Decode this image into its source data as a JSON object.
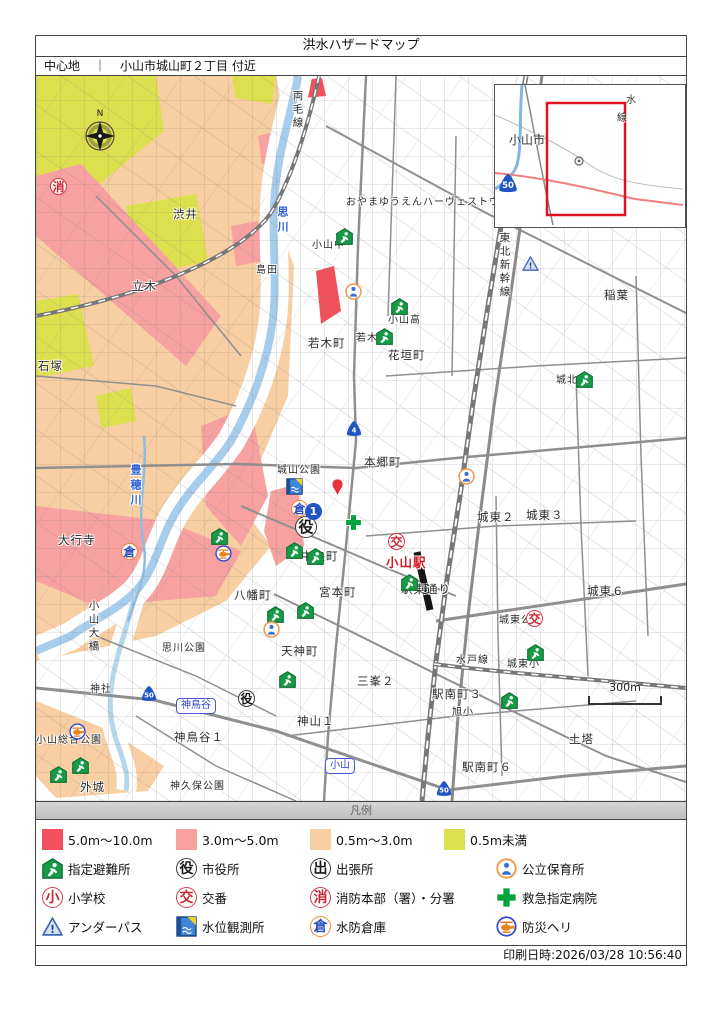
{
  "page": {
    "title": "洪水ハザードマップ",
    "center_label": "中心地",
    "separator": "｜",
    "center_value": "小山市城山町２丁目 付近",
    "print_datetime": "印刷日時:2026/03/28 10:56:40"
  },
  "inset": {
    "city": "小山市",
    "route": "50",
    "rail_char_top": "水",
    "rail_char_bottom": "線"
  },
  "map": {
    "compass": "N",
    "scale": "300m",
    "labels": [
      {
        "t": "渋井",
        "x": 137,
        "y": 133
      },
      {
        "t": "立木",
        "x": 96,
        "y": 205
      },
      {
        "t": "石塚",
        "x": 2,
        "y": 285
      },
      {
        "t": "両毛線",
        "x": 256,
        "y": 14,
        "c": "vert"
      },
      {
        "t": "思川",
        "x": 241,
        "y": 130,
        "c": "vblue"
      },
      {
        "t": "おやまゆうえんハーヴェストウォーク",
        "x": 310,
        "y": 122,
        "c": "small"
      },
      {
        "t": "小山中",
        "x": 276,
        "y": 165,
        "c": "small"
      },
      {
        "t": "島田",
        "x": 220,
        "y": 190,
        "c": "small"
      },
      {
        "t": "若木町",
        "x": 272,
        "y": 262
      },
      {
        "t": "小山高",
        "x": 352,
        "y": 240,
        "c": "small"
      },
      {
        "t": "若木小",
        "x": 320,
        "y": 258,
        "c": "small"
      },
      {
        "t": "花垣町",
        "x": 352,
        "y": 274
      },
      {
        "t": "稲葉",
        "x": 568,
        "y": 214
      },
      {
        "t": "東北新幹線",
        "x": 463,
        "y": 156,
        "c": "vert"
      },
      {
        "t": "城北小",
        "x": 520,
        "y": 300,
        "c": "small"
      },
      {
        "t": "本郷町",
        "x": 328,
        "y": 381
      },
      {
        "t": "城山公園",
        "x": 241,
        "y": 390,
        "c": "small"
      },
      {
        "t": "中央町",
        "x": 265,
        "y": 475
      },
      {
        "t": "小山駅",
        "x": 350,
        "y": 481,
        "c": "red"
      },
      {
        "t": "駅東通り",
        "x": 365,
        "y": 508
      },
      {
        "t": "宮本町",
        "x": 283,
        "y": 511
      },
      {
        "t": "八幡町",
        "x": 198,
        "y": 514
      },
      {
        "t": "大行寺",
        "x": 22,
        "y": 459
      },
      {
        "t": "豊穂川",
        "x": 94,
        "y": 388,
        "c": "vblue"
      },
      {
        "t": "思川公園",
        "x": 126,
        "y": 568,
        "c": "small"
      },
      {
        "t": "小山大橋",
        "x": 52,
        "y": 524,
        "c": "vert"
      },
      {
        "t": "天神町",
        "x": 245,
        "y": 570
      },
      {
        "t": "三峯２",
        "x": 321,
        "y": 600
      },
      {
        "t": "神山１",
        "x": 261,
        "y": 640
      },
      {
        "t": "城東２",
        "x": 441,
        "y": 436
      },
      {
        "t": "城東３",
        "x": 490,
        "y": 434
      },
      {
        "t": "城東６",
        "x": 551,
        "y": 510
      },
      {
        "t": "城東公園",
        "x": 463,
        "y": 540,
        "c": "small"
      },
      {
        "t": "城東小",
        "x": 471,
        "y": 584,
        "c": "small"
      },
      {
        "t": "水戸線",
        "x": 420,
        "y": 580,
        "c": "small"
      },
      {
        "t": "駅南町３",
        "x": 396,
        "y": 613
      },
      {
        "t": "旭小",
        "x": 416,
        "y": 632,
        "c": "small"
      },
      {
        "t": "駅南町６",
        "x": 426,
        "y": 686
      },
      {
        "t": "土塔",
        "x": 533,
        "y": 658
      },
      {
        "t": "外城",
        "x": 44,
        "y": 706
      },
      {
        "t": "神久保公園",
        "x": 134,
        "y": 706,
        "c": "small"
      },
      {
        "t": "神鳥谷１",
        "x": 138,
        "y": 656
      },
      {
        "t": "小山総合公園",
        "x": 0,
        "y": 660,
        "c": "small"
      },
      {
        "t": "神社",
        "x": 54,
        "y": 609,
        "c": "small"
      }
    ],
    "icons": [
      {
        "type": "shelter",
        "x": 300,
        "y": 152
      },
      {
        "type": "shelter",
        "x": 355,
        "y": 222
      },
      {
        "type": "shelter",
        "x": 340,
        "y": 252
      },
      {
        "type": "shelter",
        "x": 540,
        "y": 295
      },
      {
        "type": "shelter",
        "x": 175,
        "y": 452
      },
      {
        "type": "shelter",
        "x": 250,
        "y": 466
      },
      {
        "type": "shelter",
        "x": 271,
        "y": 472
      },
      {
        "type": "shelter",
        "x": 261,
        "y": 526
      },
      {
        "type": "shelter",
        "x": 231,
        "y": 530
      },
      {
        "type": "shelter",
        "x": 243,
        "y": 595
      },
      {
        "type": "shelter",
        "x": 365,
        "y": 498
      },
      {
        "type": "shelter",
        "x": 491,
        "y": 568
      },
      {
        "type": "shelter",
        "x": 465,
        "y": 616
      },
      {
        "type": "shelter",
        "x": 14,
        "y": 690
      },
      {
        "type": "shelter",
        "x": 36,
        "y": 681
      },
      {
        "type": "yakusho",
        "x": 259,
        "y": 440,
        "s": 22
      },
      {
        "type": "yakusho",
        "x": 202,
        "y": 614,
        "s": 17
      },
      {
        "type": "koban",
        "x": 352,
        "y": 457
      },
      {
        "type": "koban",
        "x": 490,
        "y": 534
      },
      {
        "type": "shobo",
        "x": 14,
        "y": 102
      },
      {
        "type": "hoiku",
        "x": 309,
        "y": 207
      },
      {
        "type": "hoiku",
        "x": 422,
        "y": 392
      },
      {
        "type": "hoiku",
        "x": 227,
        "y": 545
      },
      {
        "type": "kura",
        "x": 255,
        "y": 424
      },
      {
        "type": "kura",
        "x": 85,
        "y": 467
      },
      {
        "type": "heli",
        "x": 179,
        "y": 469
      },
      {
        "type": "heli",
        "x": 33,
        "y": 647
      },
      {
        "type": "gauge",
        "x": 250,
        "y": 402
      },
      {
        "type": "cross",
        "x": 309,
        "y": 438
      },
      {
        "type": "underpass",
        "x": 486,
        "y": 180
      },
      {
        "type": "balloon",
        "x": 295,
        "y": 403
      },
      {
        "type": "route1",
        "x": 269,
        "y": 427
      }
    ],
    "shields": [
      {
        "n": "4",
        "x": 309,
        "y": 344
      },
      {
        "n": "50",
        "x": 104,
        "y": 609
      },
      {
        "n": "50",
        "x": 399,
        "y": 704
      }
    ],
    "boxes": [
      {
        "t": "神鳥谷",
        "x": 140,
        "y": 622
      },
      {
        "t": "小山",
        "x": 289,
        "y": 682
      }
    ]
  },
  "legend": {
    "header": "凡例",
    "depths": [
      {
        "label": "5.0m～10.0m",
        "color": "#f1515c"
      },
      {
        "label": "3.0m～5.0m",
        "color": "#f7a1a1"
      },
      {
        "label": "0.5m～3.0m",
        "color": "#f8cfa2"
      },
      {
        "label": "0.5m未満",
        "color": "#dde04e"
      }
    ],
    "rows": [
      [
        {
          "icon": "shelter",
          "label": "指定避難所"
        },
        {
          "icon": "yakusho",
          "label": "市役所"
        },
        {
          "icon": "shutcho",
          "label": "出張所"
        },
        {
          "icon": "hoiku",
          "label": "公立保育所"
        }
      ],
      [
        {
          "icon": "shogakko",
          "label": "小学校"
        },
        {
          "icon": "koban",
          "label": "交番"
        },
        {
          "icon": "shobo",
          "label": "消防本部（署）・分署"
        },
        {
          "icon": "cross",
          "label": "救急指定病院"
        }
      ],
      [
        {
          "icon": "underpass",
          "label": "アンダーパス"
        },
        {
          "icon": "gauge",
          "label": "水位観測所"
        },
        {
          "icon": "kura",
          "label": "水防倉庫"
        },
        {
          "icon": "heli",
          "label": "防災ヘリ"
        }
      ]
    ]
  }
}
